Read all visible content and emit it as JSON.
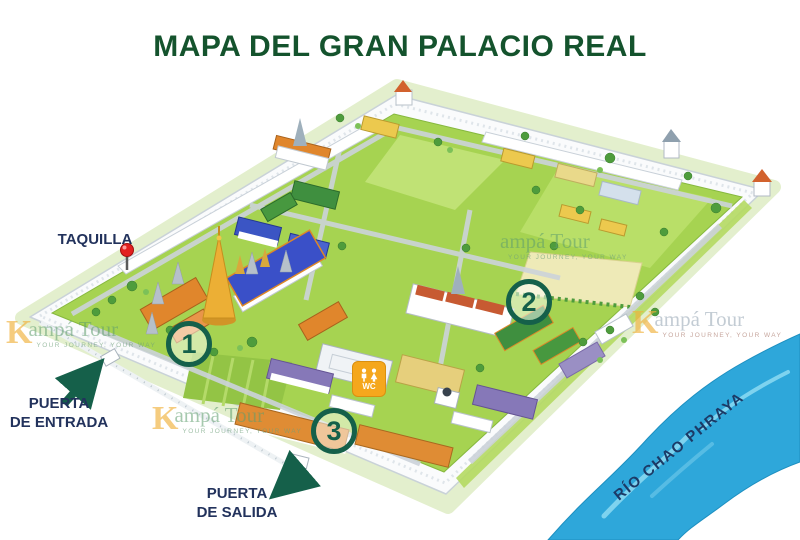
{
  "title": "MAPA DEL GRAN PALACIO REAL",
  "map": {
    "ticket_office_label": "TAQUILLA",
    "entrance_label_line1": "PUERTA",
    "entrance_label_line2": "DE ENTRADA",
    "exit_label_line1": "PUERTA",
    "exit_label_line2": "DE SALIDA",
    "river_label": "RÍO CHAO PHRAYA",
    "markers": {
      "one": "1",
      "two": "2",
      "three": "3"
    },
    "wc_label": "WC"
  },
  "watermark": {
    "initial": "K",
    "brand": "ampá Tour",
    "tagline": "YOUR JOURNEY, YOUR WAY"
  },
  "colors": {
    "title_green": "#14532d",
    "label_navy": "#22325c",
    "river_label_navy": "#1c3a66",
    "arrow_green": "#15604a",
    "marker_green": "#15604a",
    "river_blue": "#2ea7da",
    "pin_red": "#e32020",
    "wc_amber": "#f5a71d",
    "lawn_green": "#a6d351",
    "wall_white": "#fafbfc"
  }
}
